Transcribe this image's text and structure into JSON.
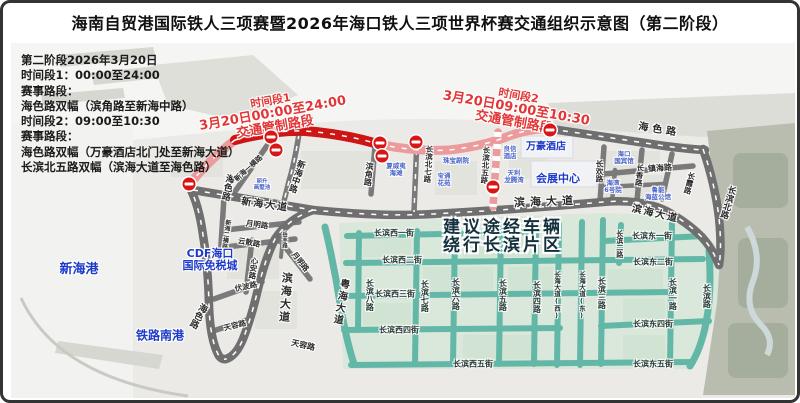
{
  "title": "海南自贸港国际铁人三项赛暨2026年海口铁人三项世界杯赛交通组织示意图（第二阶段）",
  "info_panel": {
    "lines": [
      "第二阶段2026年3月20日",
      "时间段1：00:00至24:00",
      "赛事路段：",
      "海色路双幅（滨角路至新海中路）",
      "时间段2：09:00至10:30",
      "赛事路段：",
      "海色路双幅（万豪酒店北门处至新海大道）",
      "长滨北五路双幅（滨海大道至海色路）"
    ]
  },
  "map": {
    "colors": {
      "control_closed_road": "#ce1515",
      "control_restricted_road": "#eb9b9b",
      "major_road": "#6f6f6f",
      "local_grid_road": "#63b7a6",
      "landmark_text": "#1d39c8",
      "advisory_text": "#13303c",
      "control_label_text": "#e23636",
      "no_entry_sign": "#d81616"
    },
    "control_labels": [
      {
        "lines": [
          "时间段1",
          "3月20日00:00至24:00",
          "交通管制路段"
        ],
        "x": 270,
        "y": 112,
        "rot": -10
      },
      {
        "lines": [
          "时间段2",
          "3月20日09:00至10:30",
          "交通管制路段"
        ],
        "x": 513,
        "y": 107,
        "rot": 10
      }
    ],
    "advisory": {
      "lines": [
        "建议途经车辆",
        "绕行长滨片区"
      ],
      "x": 500,
      "y": 234
    },
    "road_labels": [
      {
        "t": "海色路",
        "x": 223,
        "y": 184,
        "vert": 1,
        "rot": 12,
        "fs": 9
      },
      {
        "t": "海色路",
        "x": 194,
        "y": 312,
        "vert": 1,
        "rot": 28,
        "fs": 9
      },
      {
        "t": "海色路",
        "x": 656,
        "y": 128,
        "rot": 9,
        "fs": 10,
        "ls": 4
      },
      {
        "t": "新海大道",
        "x": 262,
        "y": 203,
        "rot": 8,
        "fs": 10,
        "ls": 2
      },
      {
        "t": "新海中路",
        "x": 293,
        "y": 173,
        "vert": 1,
        "rot": 18,
        "fs": 8.5
      },
      {
        "t": "新海一横路",
        "x": 246,
        "y": 166,
        "rot": -42,
        "fs": 7
      },
      {
        "t": "新海二横路",
        "x": 222,
        "y": 231,
        "vert": 1,
        "rot": 8,
        "fs": 6
      },
      {
        "t": "滨角路",
        "x": 365,
        "y": 171,
        "vert": 1,
        "rot": 6,
        "fs": 8
      },
      {
        "t": "月明路",
        "x": 254,
        "y": 222,
        "rot": 8,
        "fs": 7.5
      },
      {
        "t": "云散路",
        "x": 246,
        "y": 240,
        "rot": 10,
        "fs": 7.5
      },
      {
        "t": "心安路",
        "x": 250,
        "y": 265,
        "vert": 1,
        "rot": 8,
        "fs": 7.5
      },
      {
        "t": "伏波路",
        "x": 243,
        "y": 284,
        "rot": -12,
        "fs": 7.5
      },
      {
        "t": "月明路",
        "x": 297,
        "y": 259,
        "rot": 52,
        "fs": 7.5
      },
      {
        "t": "岳丰路",
        "x": 280,
        "y": 237,
        "vert": 1,
        "fs": 5.5
      },
      {
        "t": "天容路",
        "x": 232,
        "y": 323,
        "rot": -14,
        "fs": 7.5
      },
      {
        "t": "天容路",
        "x": 300,
        "y": 343,
        "rot": 13,
        "fs": 8
      },
      {
        "t": "滨海大道",
        "x": 282,
        "y": 295,
        "vert": 1,
        "rot": 4,
        "fs": 11,
        "ls": 2
      },
      {
        "t": "滨海大道",
        "x": 543,
        "y": 199,
        "rot": -2,
        "fs": 11,
        "ls": 5
      },
      {
        "t": "滨海大道",
        "x": 652,
        "y": 212,
        "rot": 13,
        "fs": 10,
        "ls": 2
      },
      {
        "t": "粤海大道",
        "x": 336,
        "y": 299,
        "vert": 1,
        "rot": 10,
        "fs": 10,
        "ls": 2
      },
      {
        "t": "长滨北七路",
        "x": 425,
        "y": 161,
        "vert": 1,
        "rot": 4,
        "fs": 7.5
      },
      {
        "t": "长滨北五路",
        "x": 482,
        "y": 162,
        "vert": 1,
        "rot": 4,
        "fs": 7.5
      },
      {
        "t": "长欢路",
        "x": 596,
        "y": 168,
        "vert": 1,
        "fs": 7.5
      },
      {
        "t": "长香路",
        "x": 636,
        "y": 172,
        "vert": 1,
        "rot": 6,
        "fs": 7.5
      },
      {
        "t": "长霞路",
        "x": 686,
        "y": 180,
        "vert": 1,
        "rot": 14,
        "fs": 7.5
      },
      {
        "t": "镇海路",
        "x": 657,
        "y": 166,
        "rot": -4,
        "fs": 8
      },
      {
        "t": "长滨北路",
        "x": 724,
        "y": 199,
        "vert": 1,
        "rot": 16,
        "fs": 8.5
      },
      {
        "t": "长滨二路",
        "x": 616,
        "y": 241,
        "vert": 1,
        "fs": 7
      }
    ],
    "street_labels": [
      {
        "t": "长滨西一街",
        "x": 391,
        "y": 231
      },
      {
        "t": "长滨东一街",
        "x": 649,
        "y": 234
      },
      {
        "t": "长滨西二街",
        "x": 399,
        "y": 258
      },
      {
        "t": "长滨东二街",
        "x": 650,
        "y": 260
      },
      {
        "t": "长滨西三街",
        "x": 392,
        "y": 292
      },
      {
        "t": "长滨西四街",
        "x": 396,
        "y": 328
      },
      {
        "t": "长滨东四街",
        "x": 650,
        "y": 322
      },
      {
        "t": "长滨西五街",
        "x": 470,
        "y": 362
      },
      {
        "t": "长滨东五街",
        "x": 650,
        "y": 362
      },
      {
        "t": "长滨八路",
        "x": 366,
        "y": 292,
        "vert": 1
      },
      {
        "t": "长滨七路",
        "x": 421,
        "y": 293,
        "vert": 1
      },
      {
        "t": "长滨六路",
        "x": 452,
        "y": 291,
        "vert": 1
      },
      {
        "t": "长滨五路",
        "x": 499,
        "y": 292,
        "vert": 1
      },
      {
        "t": "长滨四路",
        "x": 533,
        "y": 294,
        "vert": 1
      },
      {
        "t": "长海大道(西)",
        "x": 553,
        "y": 292,
        "vert": 1,
        "fs": 6.5
      },
      {
        "t": "长海大道(东)",
        "x": 578,
        "y": 292,
        "vert": 1,
        "fs": 6.5
      },
      {
        "t": "长滨三路",
        "x": 598,
        "y": 290,
        "vert": 1
      },
      {
        "t": "长滨一路",
        "x": 669,
        "y": 291,
        "vert": 1
      },
      {
        "t": "长滨路",
        "x": 703,
        "y": 293,
        "vert": 1
      }
    ],
    "landmarks": [
      {
        "lines": [
          "新海港"
        ],
        "x": 76,
        "y": 267,
        "fs": 13
      },
      {
        "lines": [
          "CDF海口",
          "国际免税城"
        ],
        "x": 207,
        "y": 257,
        "fs": 11
      },
      {
        "lines": [
          "铁路南港"
        ],
        "x": 157,
        "y": 333,
        "fs": 12
      },
      {
        "lines": [
          "万豪酒店"
        ],
        "x": 543,
        "y": 145,
        "fs": 10
      },
      {
        "lines": [
          "会展中心"
        ],
        "x": 555,
        "y": 176,
        "fs": 11
      }
    ],
    "landmarks_small": [
      {
        "lines": [
          "海口",
          "国宾馆"
        ],
        "x": 621,
        "y": 155
      },
      {
        "lines": [
          "海湾",
          "6号院"
        ],
        "x": 610,
        "y": 184
      },
      {
        "lines": [
          "鲁能",
          "海蓝公馆"
        ],
        "x": 655,
        "y": 191
      },
      {
        "lines": [
          "珠宝剧院"
        ],
        "x": 453,
        "y": 158
      },
      {
        "lines": [
          "宝通",
          "花苑"
        ],
        "x": 441,
        "y": 177
      },
      {
        "lines": [
          "夏威夷",
          "海滩"
        ],
        "x": 393,
        "y": 167
      },
      {
        "lines": [
          "良信",
          "酒店"
        ],
        "x": 507,
        "y": 150
      },
      {
        "lines": [
          "天利",
          "龙腾湾"
        ],
        "x": 511,
        "y": 174
      },
      {
        "lines": [
          "丽升",
          "画墅池"
        ],
        "x": 259,
        "y": 183,
        "fs": 5.5
      }
    ],
    "no_entry_markers": [
      {
        "x": 186,
        "y": 181
      },
      {
        "x": 268,
        "y": 134
      },
      {
        "x": 273,
        "y": 147
      },
      {
        "x": 377,
        "y": 140
      },
      {
        "x": 379,
        "y": 153
      },
      {
        "x": 413,
        "y": 139
      },
      {
        "x": 490,
        "y": 184
      },
      {
        "x": 547,
        "y": 127
      }
    ]
  }
}
